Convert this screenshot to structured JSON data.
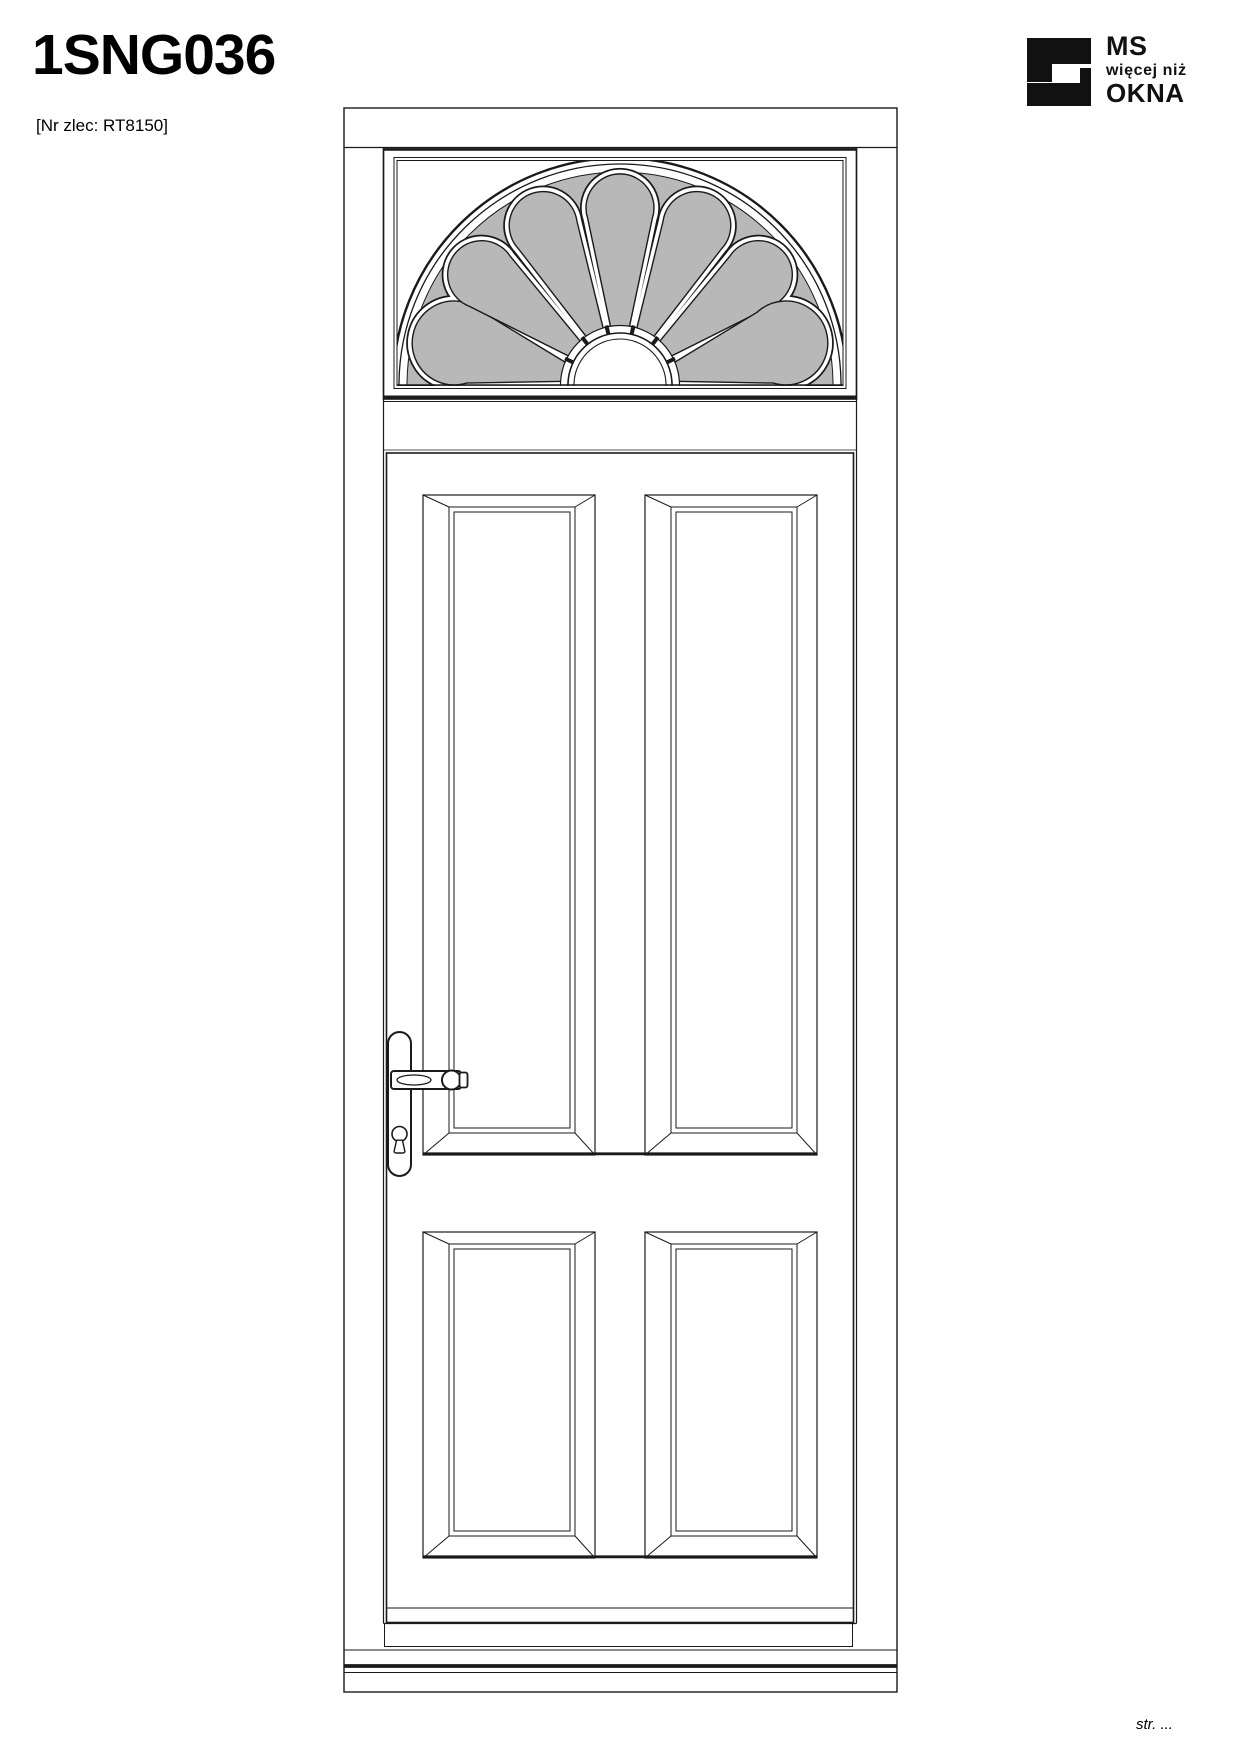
{
  "page": {
    "title": "1SNG036",
    "order_ref": "[Nr zlec: RT8150]",
    "footer": "str. ..."
  },
  "logo": {
    "top": "MS",
    "middle": "więcej niż",
    "bottom": "OKNA"
  },
  "colors": {
    "line": "#1a1a1a",
    "glass_fill": "#b7b8b7",
    "logo_black": "#111111"
  },
  "drawing": {
    "kind": "door elevation with fanlight transom",
    "fanlight": {
      "petal_count": 7
    }
  }
}
